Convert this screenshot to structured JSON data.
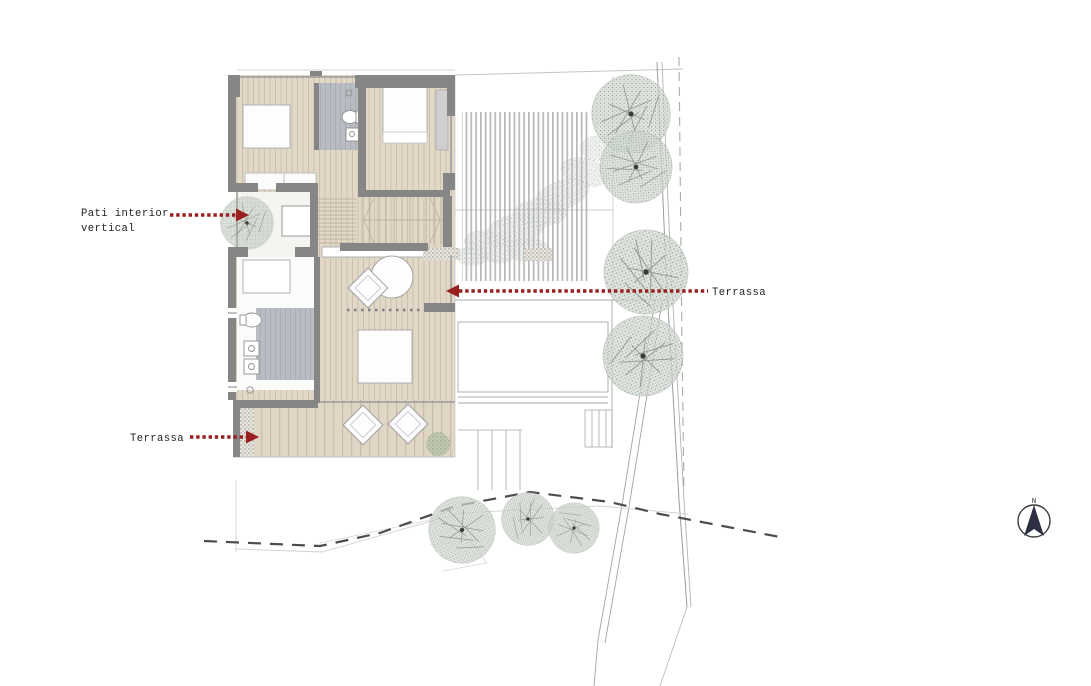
{
  "drawing": {
    "type": "architectural-floor-plan",
    "annotations": {
      "pati_interior": {
        "line1": "Pati interior",
        "line2": "vertical"
      },
      "terrassa_east": {
        "label": "Terrassa"
      },
      "terrassa_south": {
        "label": "Terrassa"
      }
    },
    "compass": {
      "north_label": "N"
    },
    "colors": {
      "annotation_red": "#9a1f1f",
      "wall_gray": "#868686",
      "wood_floor": "#e2d8c8",
      "wood_stripe": "#cdc1ae",
      "tile_gray": "#b9bdc3",
      "tree_green": "#d3dbd2",
      "compass_navy": "#2c3042"
    }
  }
}
